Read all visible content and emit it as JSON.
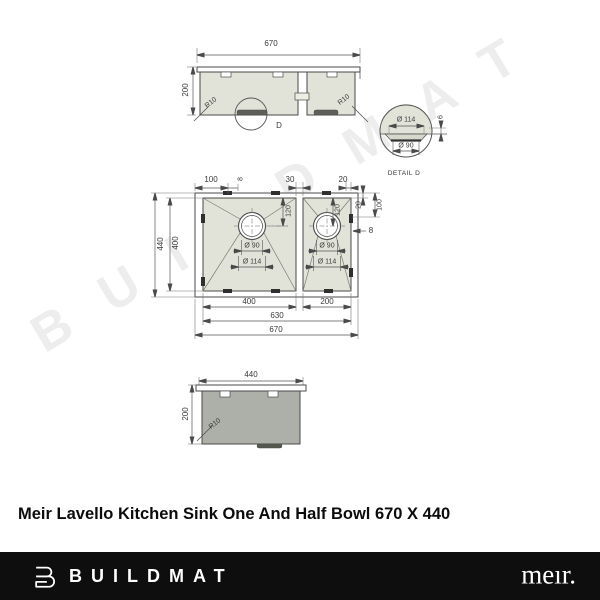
{
  "watermark": {
    "text": "BUILDMAT"
  },
  "title": "Meir Lavello Kitchen Sink One And Half Bowl 670 X 440",
  "front_view": {
    "width": "670",
    "height": "200",
    "radius_left": "R10",
    "radius_right": "R10",
    "detail_marker": "D"
  },
  "detail_view": {
    "outer_diameter": "Ø 114",
    "inner_diameter": "Ø 90",
    "depth": "6",
    "caption": "DETAIL D"
  },
  "plan_view": {
    "top_offset": "100",
    "top_clip": "8",
    "bowl_gap": "30",
    "top_right_offset": "20",
    "right_rim_offset": "20",
    "right_drain_offset": "100",
    "right_gap": "8",
    "overall_depth": "440",
    "bowl_depth": "400",
    "left_drain_depth": "120",
    "left_inner_dia": "Ø 90",
    "left_outer_dia": "Ø 114",
    "right_drain_depth": "120",
    "right_inner_dia": "Ø 90",
    "right_outer_dia": "Ø 114",
    "left_bowl_width": "400",
    "right_bowl_width": "200",
    "inner_width": "630",
    "overall_width": "670"
  },
  "side_view": {
    "width": "440",
    "height": "200",
    "radius": "R10"
  },
  "footer": {
    "brand": "BUILDMAT",
    "meir_logo": "meır."
  },
  "colors": {
    "steel_light": "#e1e3d8",
    "steel_dark": "#adb0a8",
    "line": "#4a4a4a",
    "watermark": "#ededed",
    "footer_bg": "#0e0e0e"
  }
}
